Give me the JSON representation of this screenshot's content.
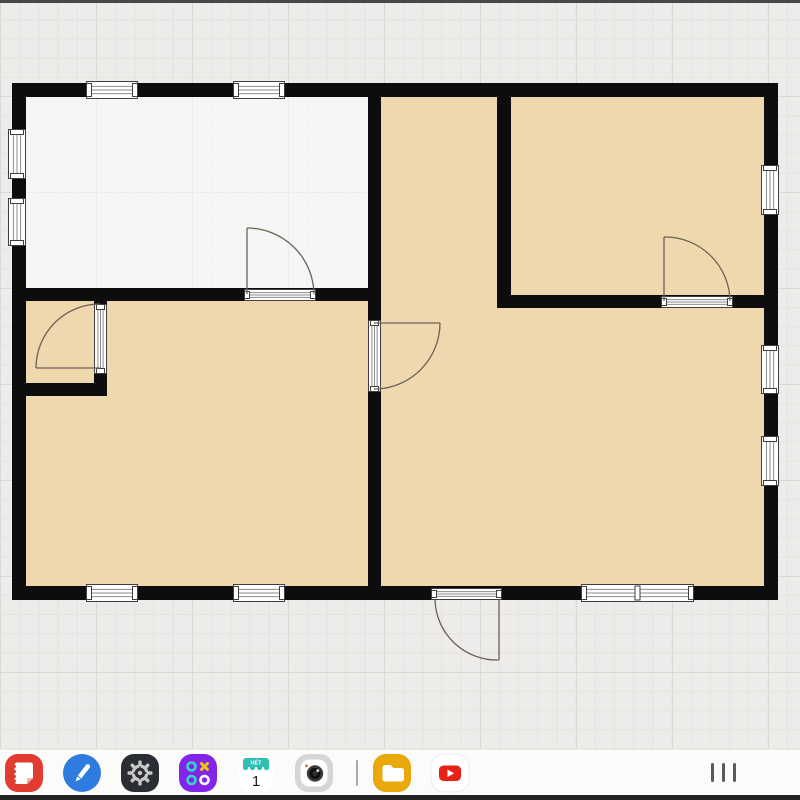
{
  "theme": {
    "canvas_bg": "#edecea",
    "grid_minor": "#e4e3e0",
    "grid_major": "#d9d8d5",
    "wall": "#0d0d0d",
    "room_tan": "#f0d8ae",
    "room_white": "rgba(255,255,255,0.55)",
    "door_line": "#6b6257",
    "window_stroke": "#3f3f3f",
    "window_line": "#8d8d8d",
    "dock_bg": "#fbfbfa"
  },
  "floor_plan": {
    "rooms": [
      {
        "name": "top-left",
        "x": 26,
        "y": 97,
        "w": 342,
        "h": 191,
        "fill": "white"
      },
      {
        "name": "bottom-left",
        "x": 26,
        "y": 301,
        "w": 342,
        "h": 285,
        "fill": "tan"
      },
      {
        "name": "right",
        "x": 381,
        "y": 97,
        "w": 383,
        "h": 489,
        "fill": "tan"
      }
    ],
    "walls": [
      [
        12,
        83,
        766,
        14
      ],
      [
        12,
        586,
        766,
        14
      ],
      [
        12,
        83,
        14,
        517
      ],
      [
        764,
        83,
        14,
        517
      ],
      [
        12,
        288,
        368,
        13
      ],
      [
        368,
        97,
        13,
        489
      ],
      [
        497,
        97,
        14,
        211
      ],
      [
        497,
        295,
        267,
        13
      ],
      [
        12,
        383,
        95,
        13
      ],
      [
        94,
        288,
        13,
        17
      ],
      [
        94,
        373,
        13,
        23
      ]
    ],
    "windows": [
      {
        "o": "h",
        "x": 86,
        "y": 81,
        "w": 52,
        "h": 18
      },
      {
        "o": "h",
        "x": 233,
        "y": 81,
        "w": 52,
        "h": 18
      },
      {
        "o": "h",
        "x": 86,
        "y": 584,
        "w": 52,
        "h": 18
      },
      {
        "o": "h",
        "x": 233,
        "y": 584,
        "w": 52,
        "h": 18
      },
      {
        "o": "h",
        "x": 581,
        "y": 584,
        "w": 113,
        "h": 18,
        "divider": true
      },
      {
        "o": "v",
        "x": 8,
        "y": 129,
        "w": 18,
        "h": 50
      },
      {
        "o": "v",
        "x": 8,
        "y": 198,
        "w": 18,
        "h": 48
      },
      {
        "o": "v",
        "x": 761,
        "y": 165,
        "w": 18,
        "h": 50
      },
      {
        "o": "v",
        "x": 761,
        "y": 345,
        "w": 18,
        "h": 49
      },
      {
        "o": "v",
        "x": 761,
        "y": 436,
        "w": 18,
        "h": 50
      }
    ],
    "doors": [
      {
        "t": {
          "o": "h",
          "x": 244,
          "y": 289,
          "w": 72,
          "h": 12
        },
        "panel": [
          247,
          294,
          247,
          228
        ],
        "arc": [
          247,
          228,
          314,
          294
        ],
        "r": 67
      },
      {
        "t": {
          "o": "v",
          "x": 94,
          "y": 304,
          "w": 13,
          "h": 70
        },
        "panel": [
          100,
          368,
          36,
          368
        ],
        "arc": [
          36,
          368,
          100,
          304
        ],
        "r": 64
      },
      {
        "t": {
          "o": "v",
          "x": 368,
          "y": 320,
          "w": 13,
          "h": 72
        },
        "panel": [
          374,
          323,
          440,
          323
        ],
        "arc": [
          440,
          323,
          374,
          389
        ],
        "r": 66
      },
      {
        "t": {
          "o": "h",
          "x": 661,
          "y": 296,
          "w": 72,
          "h": 12
        },
        "panel": [
          664,
          301,
          664,
          237
        ],
        "arc": [
          664,
          237,
          730,
          301
        ],
        "r": 65
      },
      {
        "t": {
          "o": "h",
          "x": 431,
          "y": 588,
          "w": 71,
          "h": 12
        },
        "panel": [
          499,
          600,
          499,
          660
        ],
        "arc": [
          499,
          660,
          435,
          600
        ],
        "r": 62
      }
    ]
  },
  "dock": {
    "items": [
      {
        "name": "notes",
        "color": "#e23b30"
      },
      {
        "name": "pen",
        "color": "#2e7ce0"
      },
      {
        "name": "settings",
        "color": "#2b2d35"
      },
      {
        "name": "game-hub",
        "color": "#8325e8"
      },
      {
        "name": "calendar",
        "color": "#ffffff",
        "accent": "#2fbfb4"
      },
      {
        "name": "camera",
        "color": "#d6d6d6"
      },
      {
        "name": "folder",
        "color": "#e9a90c"
      },
      {
        "name": "youtube",
        "color": "#ffffff",
        "accent": "#e62117"
      }
    ],
    "calendar": {
      "banner": "HÉT",
      "day": "1"
    }
  }
}
